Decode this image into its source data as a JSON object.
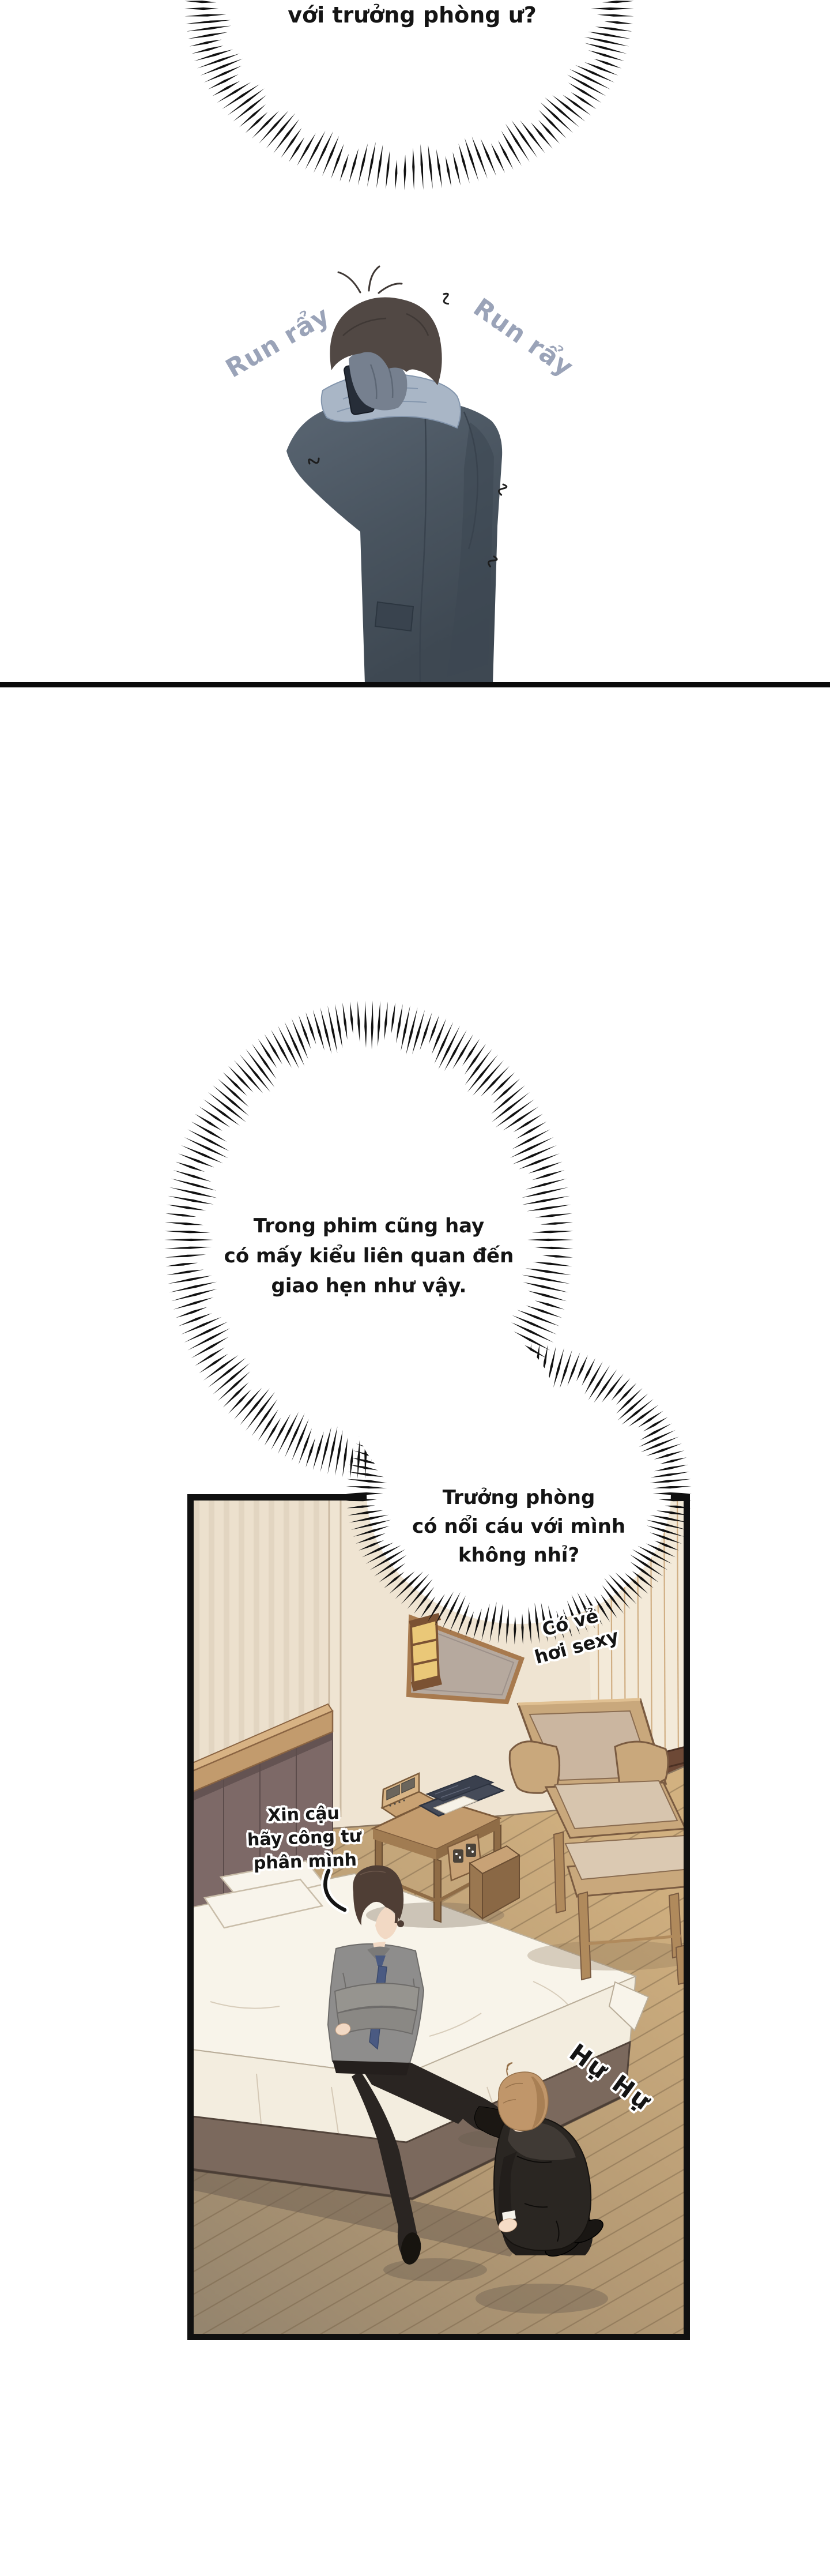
{
  "page_title": "comic-page",
  "panel_top": {
    "speech_top": {
      "text": "với trưởng phòng ư?"
    },
    "sfx_tremble_left": "Run rẩy",
    "sfx_tremble_right": "Run rẩy"
  },
  "panel_bottom": {
    "thought_main": {
      "lines": [
        "Trong phim cũng hay",
        "có mấy kiểu liên quan đến",
        "giao hẹn như vậy."
      ]
    },
    "thought_sub": {
      "lines": [
        "Trưởng phòng",
        "có nổi cáu với mình",
        "không nhỉ?"
      ]
    },
    "aside": {
      "lines": [
        "Có vẻ",
        "hơi sexy"
      ]
    },
    "speech_note": {
      "lines": [
        "Xin cậu",
        "hãy công tư",
        "phân mình"
      ]
    },
    "sfx_whimper": "Hự Hự"
  },
  "palette": {
    "ink": "#141414",
    "sfx_blue": "#9aa3b8",
    "coat": "#4b5663",
    "scarf": "#a9b6c6",
    "wall": "#efe4d2",
    "wood": "#c9a87c",
    "floor_warm": "#cfae7d",
    "floor_gray": "#97876f",
    "headboard": "#7d6967",
    "bed_white": "#f8f4ea",
    "suit_black": "#2a2622",
    "hair_brown": "#c0966a"
  }
}
